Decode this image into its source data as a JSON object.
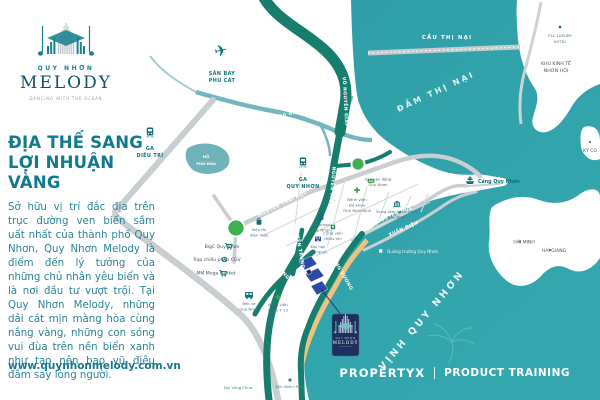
{
  "brand": {
    "name_top": "QUY NHƠN",
    "name_main": "MELODY",
    "tagline": "DANCING WITH THE OCEAN",
    "website": "www.quynhonmelody.com.vn"
  },
  "footer": {
    "left": "PROPERTYX",
    "right": "PRODUCT TRAINING"
  },
  "intro": {
    "headline_l1": "ĐỊA THẾ SANG",
    "headline_l2": "LỢI NHUẬN VÀNG",
    "body": "Sở hữu vị trí đắc địa trên trục đường ven biển sầm uất nhất của thành phố Quy Nhơn, Quy Nhơn Melody là điểm đến lý tưởng của những chủ nhân yêu biển và là nơi đầu tư vượt trội. Tại Quy Nhơn Melody, những dải cát mịn màng hòa cùng nắng vàng, những con sóng vui đùa trên nền biển xanh như tạo nên bao vũ điệu đắm say lòng người."
  },
  "badge": {
    "l1": "QUY NHƠN",
    "l2": "MELODY"
  },
  "water": {
    "cau_thi_nai": "CẦU THỊ NẠI",
    "dam_thi_nai": "ĐẦM THỊ NẠI",
    "vinh_quy_nhon": "VỊNH QUY NHƠN",
    "song_ha_thanh": "SÔNG HÀ THANH",
    "ho_phu_hoa_l1": "HỒ",
    "ho_phu_hoa_l2": "PHÚ HÒA"
  },
  "roads": {
    "vo_nguyen_giap": "VÕ NGUYÊN GIÁP",
    "nguyen_tat_thanh": "NGUYỄN TẤT THÀNH",
    "nguyen_thai_hoc": "NGUYỄN THÁI HỌC",
    "tay_son": "TÂY SƠN",
    "nguyen_hue": "NGUYỄN HUỆ",
    "xuan_dieu": "XUÂN DIỆU",
    "an_duong_vuong": "AN DƯƠNG VƯƠNG",
    "chuong_duong": "CHƯƠNG DƯƠNG",
    "nguyen_trung_tin": "NGUYỄN TRUNG TÍN"
  },
  "pois": {
    "san_bay_l1": "SÂN BAY",
    "san_bay_l2": "PHÙ CÁT",
    "ga_dieu_tri_l1": "GA",
    "ga_dieu_tri_l2": "DIÊU TRÌ",
    "ga_quy_nhon_l1": "GA",
    "ga_quy_nhon_l2": "QUY NHƠN",
    "cang_quy_nhon": "Cảng Quy Nhơn",
    "flc_l1": "FLC LUXURY",
    "flc_l2": "HOTEL",
    "nhon_hoi_l1": "KHU KINH TẾ",
    "nhon_hoi_l2": "NHƠN HỘI",
    "ky_co": "KỲ CO",
    "hai_minh": "HẢI MINH",
    "hai_giang": "HẢI GIANG",
    "bv_tinh_l1": "Bệnh viện",
    "bv_tinh_l2": "Đa khoa",
    "bv_tinh_l3": "Tỉnh Bình Định",
    "svd_l1": "Sân vận động",
    "svd_l2": "Quy Nhơn",
    "tthc_l1": "Trung tâm hành chính",
    "tthc_l2": "Quy Nhơn",
    "coopmart_l1": "Coopmart",
    "coopmart_l2": "Quy Nhơn",
    "sieu_thi_l1": "Siêu thị",
    "sieu_thi_l2": "điện máy",
    "bigc": "BigC Quy Nhơn",
    "cgv": "Rạp chiếu phim CGV",
    "mega": "MM Mega Market",
    "ben_xe_l1": "Bến xe",
    "ben_xe_l2": "Quy Nhơn",
    "quan_y_l1": "Bệnh viện",
    "quan_y_l2": "Quân Y 13",
    "dai_hoc_l1": "Đại học",
    "dai_hoc_l2": "Quy Nhơn",
    "cong_vien_l1": "Công viên",
    "cong_vien_l2": "thiếu nhi",
    "quang_truong": "Quảng trường Quy Nhơn",
    "vung_chua": "Núi Vũng Chua",
    "ghenh_rang": "KDL Ghềnh Ráng"
  },
  "colors": {
    "sea": "#2f9ea8",
    "road_green": "#177e6e",
    "road_gray": "#c9ced0",
    "accent_teal": "#10798e",
    "navy": "#1e2f5d",
    "sand": "#eec27f",
    "poi_green": "#3aa43c"
  }
}
